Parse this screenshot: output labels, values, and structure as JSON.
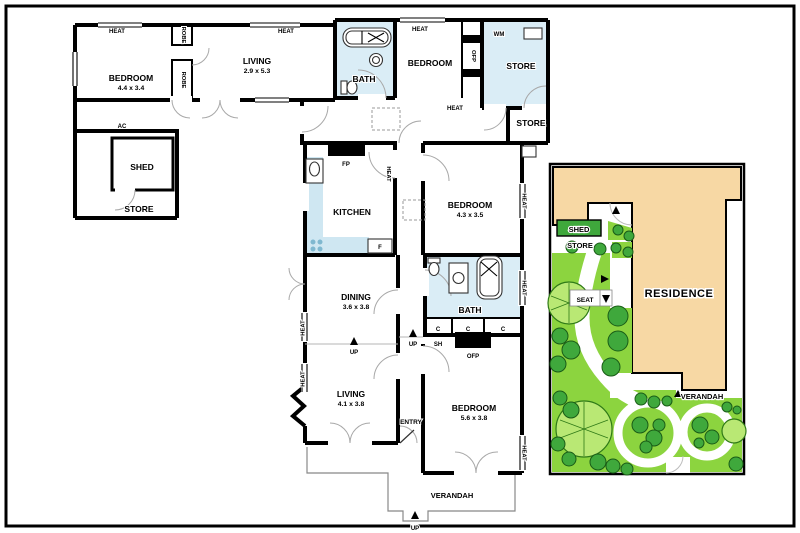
{
  "colors": {
    "wet_area": "#daedf6",
    "bench": "#cfe7f2",
    "residence": "#f7d8a4",
    "grass": "#8cd43f",
    "tree_dark": "#3fa83c",
    "tree_light": "#b9e874",
    "wall": "#000000"
  },
  "rooms": {
    "bedroom_nw": {
      "name": "BEDROOM",
      "dims": "4.4 x 3.4"
    },
    "living_nw": {
      "name": "LIVING",
      "dims": "2.9 x 5.3"
    },
    "shed": {
      "name": "SHED"
    },
    "store_sw": {
      "name": "STORE"
    },
    "bath_n": {
      "name": "BATH"
    },
    "bedroom_n": {
      "name": "BEDROOM"
    },
    "store_ne": {
      "name": "STORE"
    },
    "store_ne2": {
      "name": "STORE"
    },
    "kitchen": {
      "name": "KITCHEN"
    },
    "bedroom_e": {
      "name": "BEDROOM",
      "dims": "4.3 x 3.5"
    },
    "dining": {
      "name": "DINING",
      "dims": "3.6 x 3.8"
    },
    "bath_c": {
      "name": "BATH"
    },
    "living_s": {
      "name": "LIVING",
      "dims": "4.1 x 3.8"
    },
    "entry": {
      "name": "ENTRY"
    },
    "bedroom_s": {
      "name": "BEDROOM",
      "dims": "5.6 x 3.8"
    },
    "verandah": {
      "name": "VERANDAH"
    }
  },
  "markers": {
    "heat": "HEAT",
    "robe": "ROBE",
    "ac": "AC",
    "wm": "WM",
    "ofp": "OFP",
    "fp": "FP",
    "fridge": "F",
    "cupboard": "C",
    "shelf": "SH",
    "up": "UP"
  },
  "site": {
    "residence": "RESIDENCE",
    "verandah": "VERANDAH",
    "shed": "SHED",
    "store": "STORE",
    "seat": "SEAT"
  }
}
